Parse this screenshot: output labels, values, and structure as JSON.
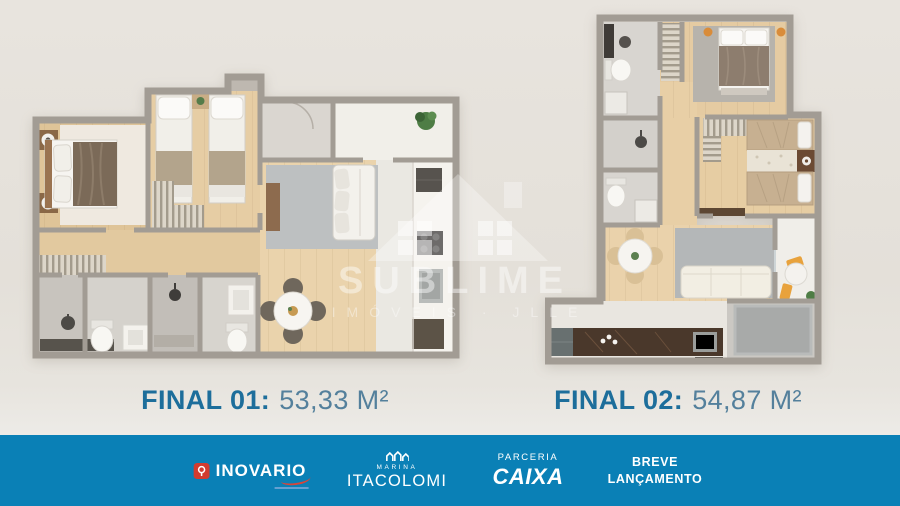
{
  "page": {
    "background_color": "#e4e0d9",
    "wall_color": "#a29c94",
    "wood_floor_color": "#ead3ac",
    "accent_orange": "#e8a23c"
  },
  "watermark": {
    "brand": "SUBLIME",
    "tagline": "IMÓVEIS · JLLE",
    "icon": "house-watermark-icon"
  },
  "plans": [
    {
      "name": "floor-plan-final-01",
      "label_title": "FINAL 01:",
      "label_area": "53,33 M²"
    },
    {
      "name": "floor-plan-final-02",
      "label_title": "FINAL 02:",
      "label_area": "54,87 M²"
    }
  ],
  "label_style": {
    "title_color": "#1d6e9b",
    "area_color": "#54809c"
  },
  "footer": {
    "background": "#0a80b6",
    "inovario": {
      "name": "INOVARIO",
      "icon": "location-pin-icon",
      "icon_color": "#d23c30"
    },
    "itacolomi": {
      "brand_top": "MARINA",
      "name": "ITACOLOMI",
      "icon": "marina-buildings-icon"
    },
    "caixa": {
      "partnership": "PARCERIA",
      "name": "CAIXA"
    },
    "launch": {
      "line1": "BREVE",
      "line2": "LANÇAMENTO"
    }
  }
}
